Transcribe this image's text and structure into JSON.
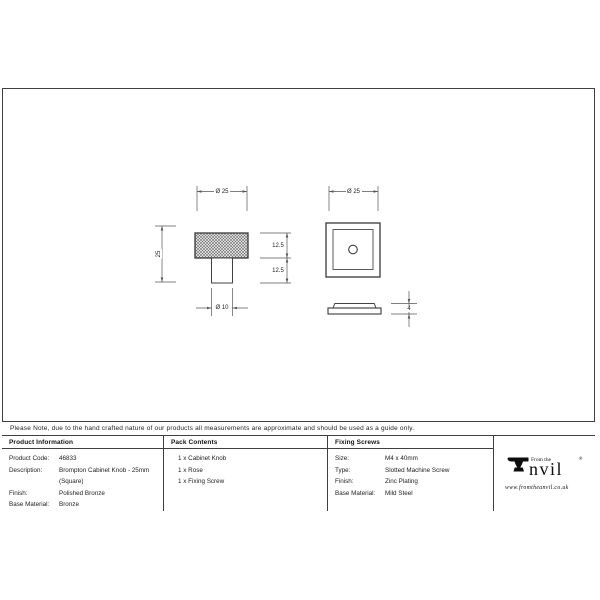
{
  "sheet": {
    "note": "Please Note, due to the hand crafted nature of our products all measurements are approximate and should be used as a guide only."
  },
  "drawing": {
    "front_view": {
      "top_diameter": "Ø 25",
      "overall_height": "25",
      "head_height": "12.5",
      "stem_height": "12.5",
      "stem_diameter": "Ø 10"
    },
    "plan_view": {
      "top_diameter": "Ø 25",
      "rose_thickness": "4"
    }
  },
  "title_block": {
    "product_information": {
      "header": "Product Information",
      "rows": [
        {
          "label": "Product Code:",
          "value": "46833"
        },
        {
          "label": "Description:",
          "value": "Brompton Cabinet Knob - 25mm"
        },
        {
          "label": "",
          "value": "(Square)"
        },
        {
          "label": "Finish:",
          "value": "Polished Bronze"
        },
        {
          "label": "Base Material:",
          "value": "Bronze"
        }
      ]
    },
    "pack_contents": {
      "header": "Pack Contents",
      "items": [
        "1 x Cabinet Knob",
        "1 x Rose",
        "1 x Fixing Screw"
      ]
    },
    "fixing_screws": {
      "header": "Fixing Screws",
      "rows": [
        {
          "label": "Size:",
          "value": "M4 x 40mm"
        },
        {
          "label": "Type:",
          "value": "Slotted Machine Screw"
        },
        {
          "label": "Finish:",
          "value": "Zinc Plating"
        },
        {
          "label": "Base Material:",
          "value": "Mild Steel"
        }
      ]
    }
  },
  "logo": {
    "prefix": "From the",
    "brand": "Anvil",
    "brand_suffix": "nvil",
    "registered_mark": "®",
    "website": "www.fromtheanvil.co.uk"
  },
  "colors": {
    "object_line": "#3d3d3d",
    "dimension_line": "#555555",
    "text": "#1f1f1f"
  }
}
